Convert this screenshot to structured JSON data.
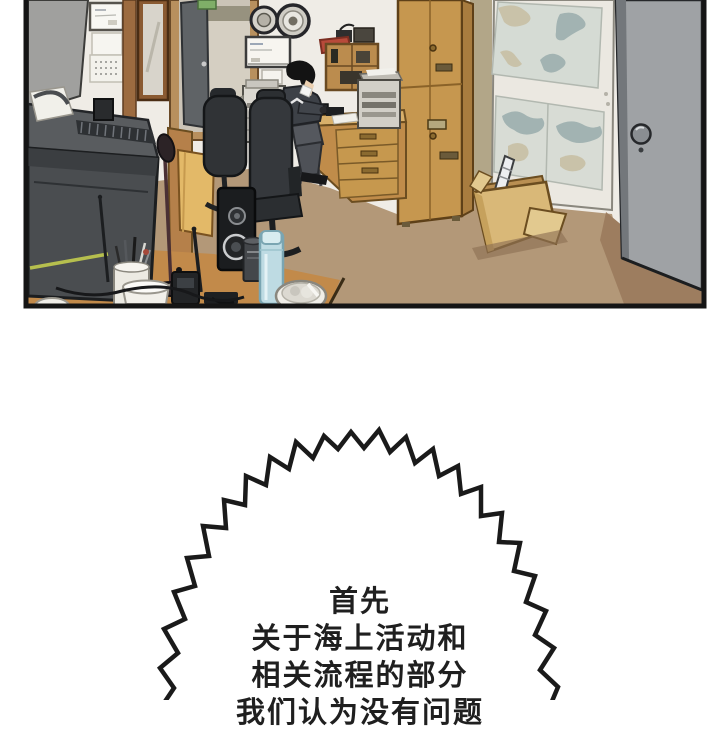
{
  "comic": {
    "panel": {
      "objects": [
        "partition-panel",
        "wall-whiteboard",
        "wall-calendar",
        "framed-mirror",
        "open-door",
        "exit-sign",
        "nautical-clock",
        "nautical-barometer",
        "notice-board",
        "copier",
        "shelf-unit",
        "red-basket",
        "storage-cabinet",
        "sea-chart-board",
        "entrance-door",
        "door-knob",
        "cardboard-box",
        "chart-roll",
        "office-chair",
        "worker-in-mask",
        "work-desk",
        "fax-machine",
        "radio-equipment",
        "desk-hutch",
        "printer",
        "monitor",
        "microphone-stand",
        "antenna",
        "pen-cup",
        "mug",
        "walkie-talkie",
        "speaker",
        "metal-can",
        "thermos-bottle",
        "trash-bowl",
        "cable"
      ]
    },
    "palette": {
      "wall": "#efece6",
      "floor": "#b39878",
      "cabinet_wood": "#c6974f",
      "desk_wood": "#c28a4a",
      "door_gray": "#9fa2a5",
      "monitor_dark": "#4a4d50",
      "monitor_highlight": "#b6bf4e",
      "thermos_blue": "#bedbe3",
      "box_cardboard": "#d9b878",
      "bubble_fill": "#ffffff",
      "line_black": "#1a1a1a"
    },
    "bubble": {
      "style": "jagged-burst",
      "lines": [
        "首先",
        "关于海上活动和",
        "相关流程的部分",
        "我们认为没有问题"
      ]
    }
  }
}
